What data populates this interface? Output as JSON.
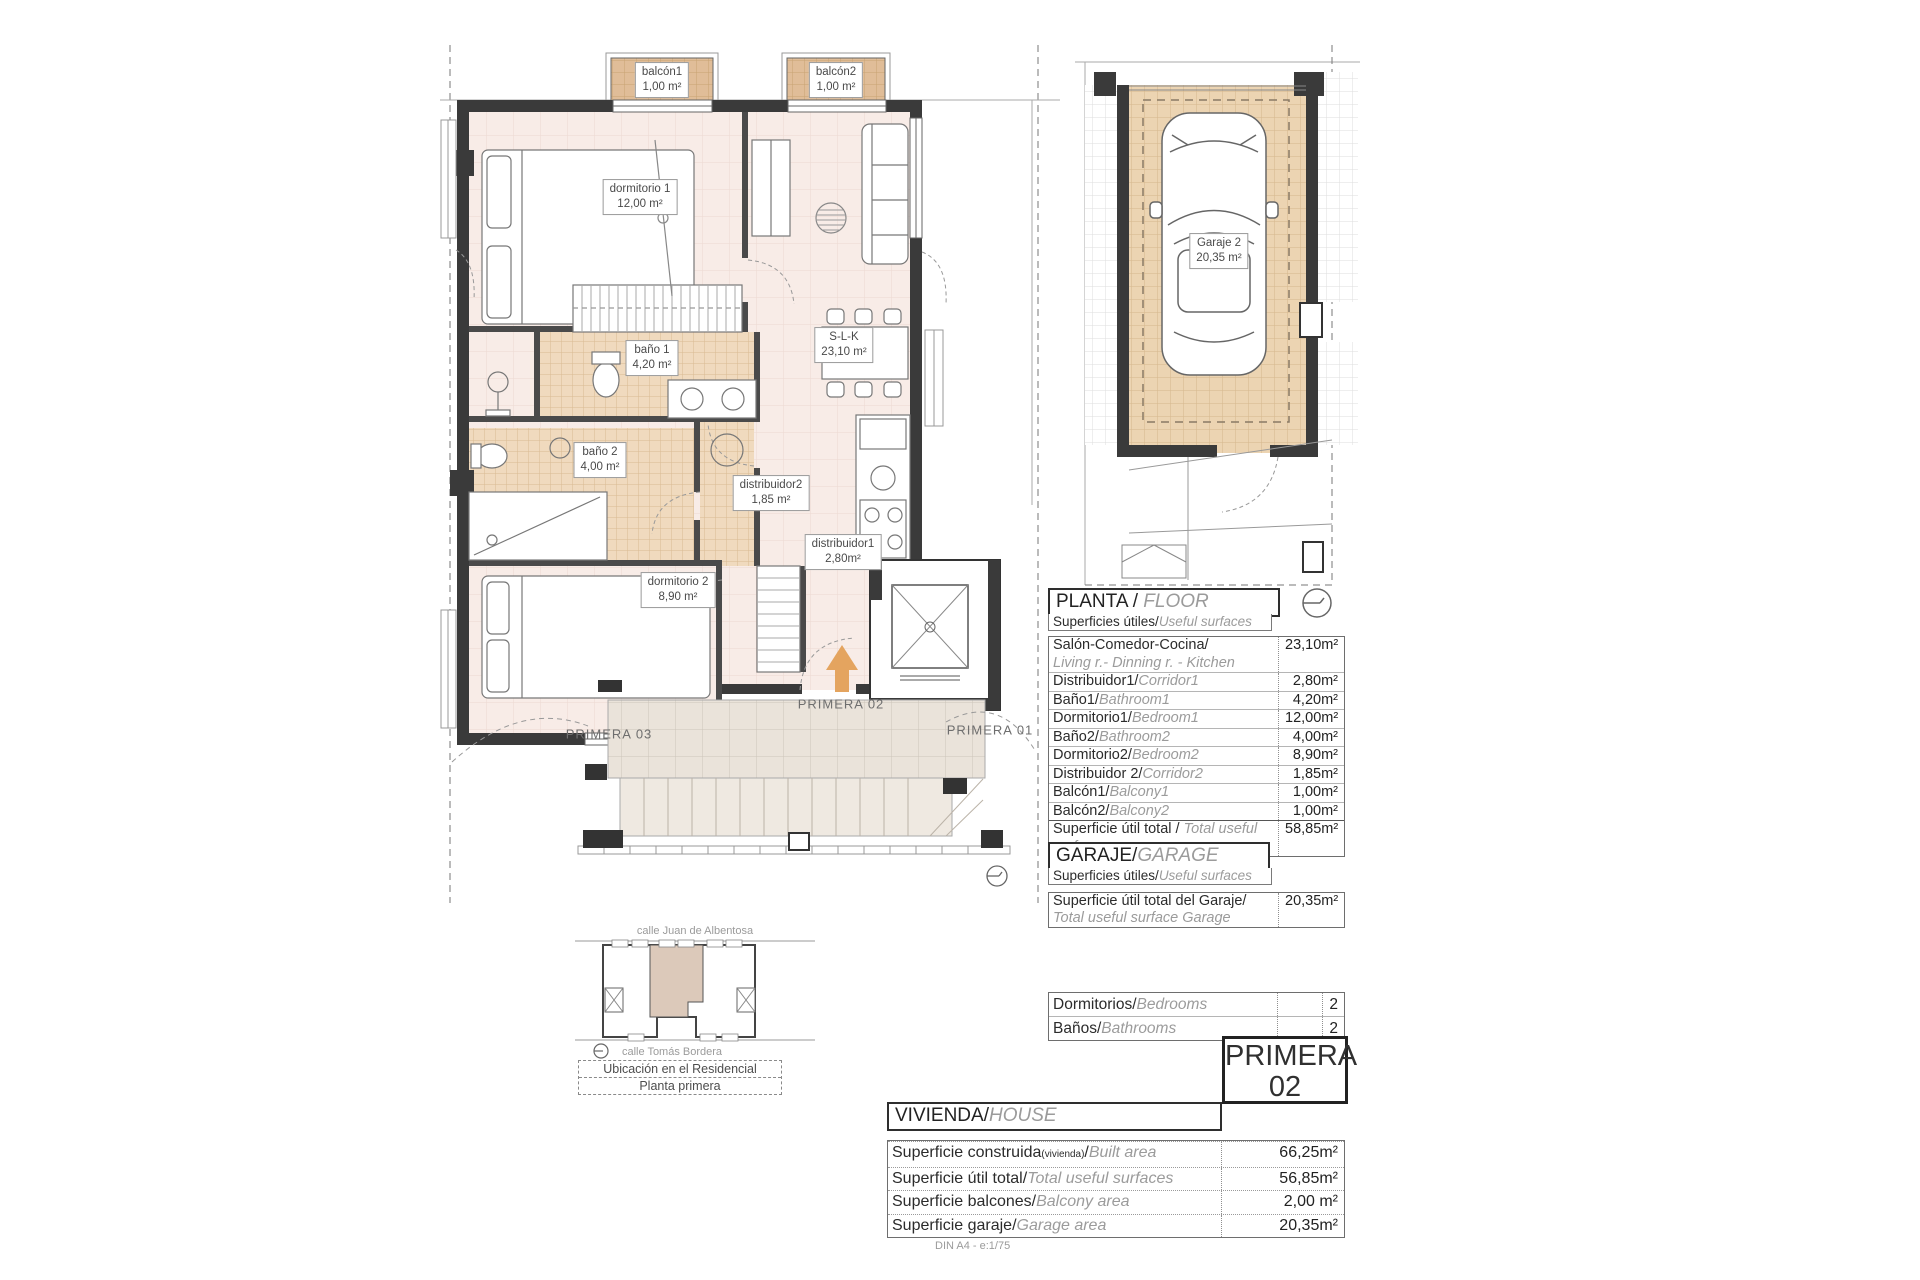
{
  "palette": {
    "floor_pink": "#f8ece7",
    "bath_tile": "#f0dabe",
    "balcony_tile": "#e0bd98",
    "terrace_tile": "#eae3da",
    "garage_tile": "#ecd4b2",
    "wall": "#3a3a3a",
    "arrow_orange": "#e4a45f",
    "unit_highlight": "#dcc9ba"
  },
  "plan": {
    "labels": {
      "balcon1": {
        "name": "balcón1",
        "area": "1,00 m²"
      },
      "balcon2": {
        "name": "balcón2",
        "area": "1,00 m²"
      },
      "dormitorio1": {
        "name": "dormitorio 1",
        "area": "12,00 m²"
      },
      "bano1": {
        "name": "baño 1",
        "area": "4,20 m²"
      },
      "slk": {
        "name": "S-L-K",
        "area": "23,10 m²"
      },
      "bano2": {
        "name": "baño 2",
        "area": "4,00 m²"
      },
      "distribuidor2": {
        "name": "distribuidor2",
        "area": "1,85 m²"
      },
      "distribuidor1": {
        "name": "distribuidor1",
        "area": "2,80m²"
      },
      "dormitorio2": {
        "name": "dormitorio 2",
        "area": "8,90 m²"
      }
    },
    "unit_left": "PRIMERA 03",
    "unit_center": "PRIMERA 02",
    "unit_right": "PRIMERA 01"
  },
  "garage_plan": {
    "label": {
      "name": "Garaje 2",
      "area": "20,35 m²"
    }
  },
  "floor_table": {
    "title_es": "PLANTA / ",
    "title_en": "FLOOR",
    "subtitle_es": "Superficies útiles/",
    "subtitle_en": "Useful surfaces",
    "rows": [
      {
        "es": "Salón-Comedor-Cocina/",
        "en": "Living r.- Dinning r. - Kitchen",
        "value": "23,10m²",
        "two_line": true
      },
      {
        "es": "Distribuidor1/",
        "en": "Corridor1",
        "value": "2,80m²"
      },
      {
        "es": "Baño1/",
        "en": "Bathroom1",
        "value": "4,20m²"
      },
      {
        "es": "Dormitorio1/",
        "en": "Bedroom1",
        "value": "12,00m²"
      },
      {
        "es": "Baño2/",
        "en": "Bathroom2",
        "value": "4,00m²"
      },
      {
        "es": "Dormitorio2/",
        "en": "Bedroom2",
        "value": "8,90m²"
      },
      {
        "es": "Distribuidor 2/",
        "en": "Corridor2",
        "value": "1,85m²"
      },
      {
        "es": "Balcón1/",
        "en": "Balcony1",
        "value": "1,00m²"
      },
      {
        "es": "Balcón2/",
        "en": "Balcony2",
        "value": "1,00m²"
      },
      {
        "es": "Superficie útil total / ",
        "en": "Total useful surface",
        "value": "58,85m²",
        "total": true
      }
    ]
  },
  "garage_table": {
    "title_es": "GARAJE/",
    "title_en": "GARAGE",
    "subtitle_es": "Superficies útiles/",
    "subtitle_en": "Useful surfaces",
    "rows": [
      {
        "es": "Superficie útil total del Garaje/",
        "en": "Total useful surface Garage",
        "value": "20,35m²",
        "two_line": true
      }
    ]
  },
  "rooms_table": {
    "rows": [
      {
        "es": "Dormitorios/",
        "en": "Bedrooms",
        "value": "2"
      },
      {
        "es": "Baños/",
        "en": "Bathrooms",
        "value": "2"
      }
    ]
  },
  "unit_badge": {
    "line1": "PRIMERA",
    "line2": "02"
  },
  "house_table": {
    "title_es": "VIVIENDA/",
    "title_en": "HOUSE",
    "rows": [
      {
        "es": "Superficie construida",
        "es_small": "(vivienda)",
        "es2": "/",
        "en": "Built area",
        "value": "66,25m²"
      },
      {
        "es": "Superficie útil total/",
        "en": "Total useful surfaces",
        "value": "56,85m²"
      },
      {
        "es": "Superficie balcones/",
        "en": "Balcony area",
        "value": "2,00 m²"
      },
      {
        "es": "Superficie garaje/",
        "en": "Garage area",
        "value": "20,35m²"
      }
    ]
  },
  "location_map": {
    "street_top": "calle Juan de Albentosa",
    "street_bottom": "calle Tomás Bordera",
    "caption_line1": "Ubicación en el Residencial",
    "caption_line2": "Planta primera"
  },
  "footer_note": "DIN A4 - e:1/75"
}
